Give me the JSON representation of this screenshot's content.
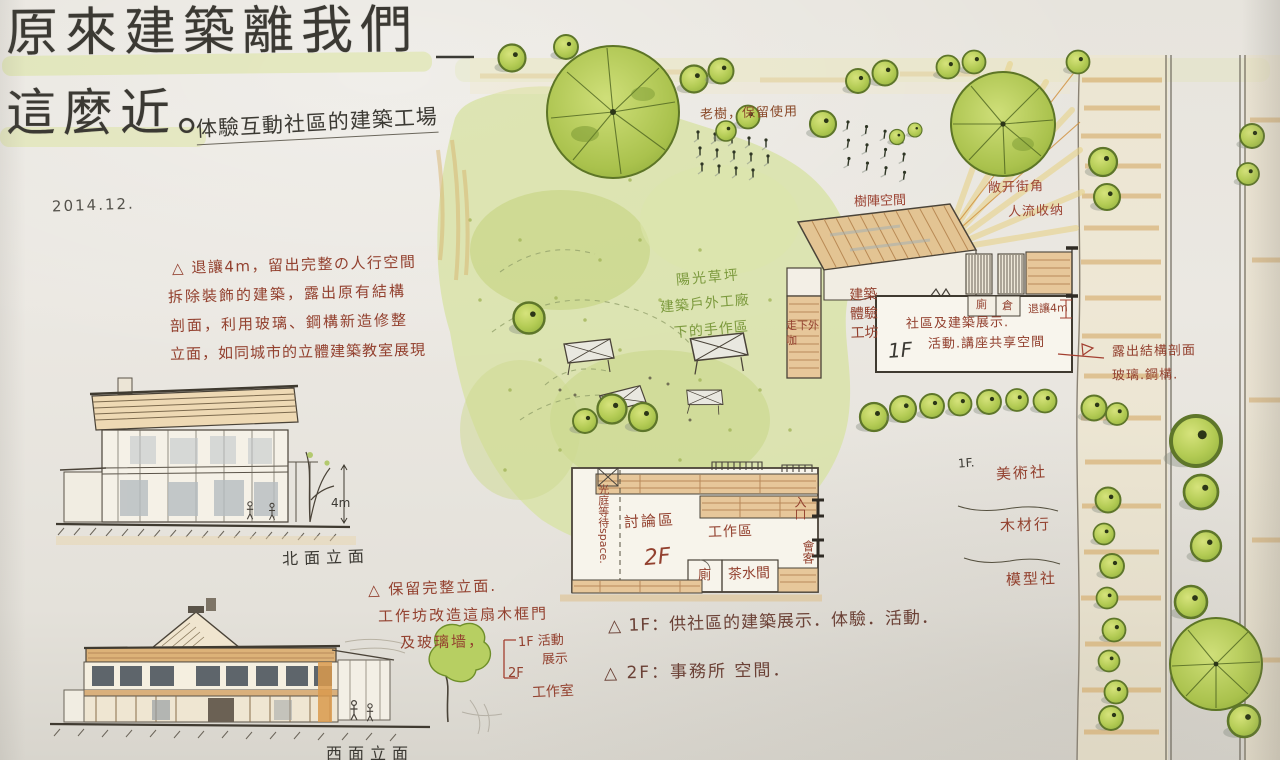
{
  "title": {
    "line1": "原來建築離我們",
    "line2": "這麼近。",
    "subtitle": "体驗互動社區的建築工場",
    "date": "2014.12."
  },
  "intro_note": {
    "lines": [
      "△ 退讓4m，留出完整の人行空間",
      "拆除裝飾的建築，露出原有結構",
      "剖面，利用玻璃、鋼構新造修整",
      "立面，如同城市的立體建築教室展現"
    ]
  },
  "elevations": {
    "north_caption": "北面立面",
    "west_caption": "西面立面",
    "height_label": "4m"
  },
  "facade_note": {
    "line1": "△ 保留完整立面.",
    "line2": "工作坊改造這扇木框門",
    "line3": "及玻璃墙，",
    "bracket_1f_a": "1F 活動",
    "bracket_1f_b": "展示",
    "bracket_2f": "2F",
    "bracket_2f_label": "工作室"
  },
  "site_plan": {
    "old_tree_label": "老樹，保留使用",
    "lawn_label_1": "陽光草坪",
    "lawn_label_2": "建築戶外工廠",
    "lawn_label_3": "下的手作區",
    "tree_array_label": "樹陣空間",
    "corner_label_1": "敞开街角",
    "corner_label_2": "人流收纳",
    "workshop_label": "建築體驗工坊",
    "cafe_label": "走下外咖",
    "building1": {
      "floor": "1F",
      "label1": "社區及建築展示.",
      "label2": "活動.講座共享空間",
      "room1": "廁",
      "room2": "倉",
      "setback": "退讓4m"
    },
    "structure_note": {
      "line1": "露出結構剖面",
      "line2": "玻璃.鋼構."
    },
    "building2": {
      "floor": "2F",
      "discussion": "討論區",
      "work": "工作區",
      "wc": "廁",
      "pantry": "茶水間",
      "entry": "入口",
      "meeting": "會客",
      "waiting": "光庭等待space."
    },
    "shops": {
      "floor": "1F.",
      "item1": "美術社",
      "item2": "木材行",
      "item3": "模型社"
    }
  },
  "legend": {
    "line1": "△ 1F：供社區的建築展示．体驗．活動．",
    "line2": "△ 2F：事務所 空間．"
  }
}
